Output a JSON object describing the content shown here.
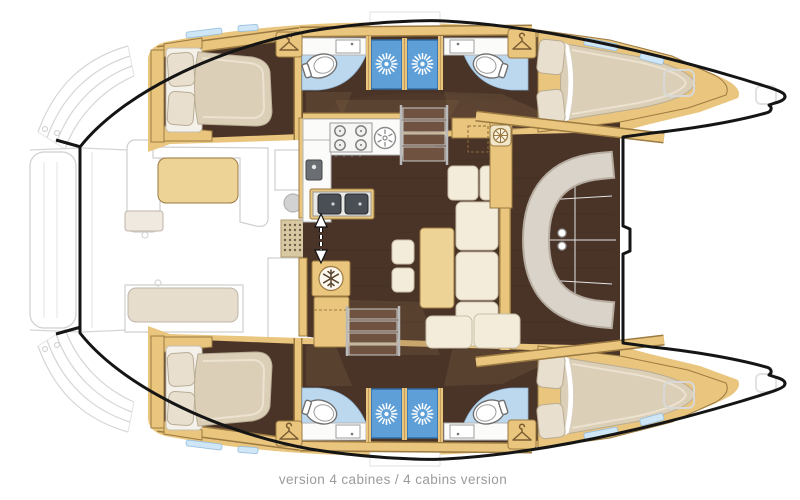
{
  "caption": {
    "text": "version 4 cabines / 4 cabins version"
  },
  "palette": {
    "wood": "#e9c57d",
    "wood_edge": "#9b7a42",
    "wood_light": "#eed396",
    "floor": "#4a3428",
    "bath_floor": "#bcd8ee",
    "shower": "#5f9fd8",
    "shower_edge": "#2f6ba6",
    "window": "#cfe6f7",
    "window_edge": "#96bedd",
    "cream": "#f3ecdb",
    "cream_edge": "#c9bfa6",
    "mattress": "#dccfb8",
    "mattress_edge": "#b9ac94",
    "seat_gray": "#dad3c9",
    "seat_gray_edge": "#b5ab9e",
    "counter": "#fbfbfa",
    "counter_edge": "#b5b5b5",
    "steel": "#4a4f55",
    "hull": "#151515",
    "caption": "#9b9b9b",
    "overlay": "#7d5f45"
  },
  "icons": [
    {
      "name": "shower-starburst-icon",
      "meaning": "shower head",
      "count": 4
    },
    {
      "name": "hanger-icon",
      "meaning": "hanging locker",
      "count": 4
    },
    {
      "name": "snowflake-icon",
      "meaning": "refrigerator",
      "count": 1
    },
    {
      "name": "stove-burners-icon",
      "meaning": "4-burner hob",
      "count": 1
    },
    {
      "name": "extractor-fan-icon",
      "meaning": "round hob / vent",
      "count": 1
    },
    {
      "name": "helm-wheel-icon",
      "meaning": "chart table / nav station",
      "count": 1
    },
    {
      "name": "slide-arrow-icon",
      "meaning": "sliding saloon door",
      "count": 1
    },
    {
      "name": "sink-icon",
      "meaning": "washbasin",
      "count": 4
    },
    {
      "name": "toilet-icon",
      "meaning": "marine toilet",
      "count": 4
    }
  ]
}
